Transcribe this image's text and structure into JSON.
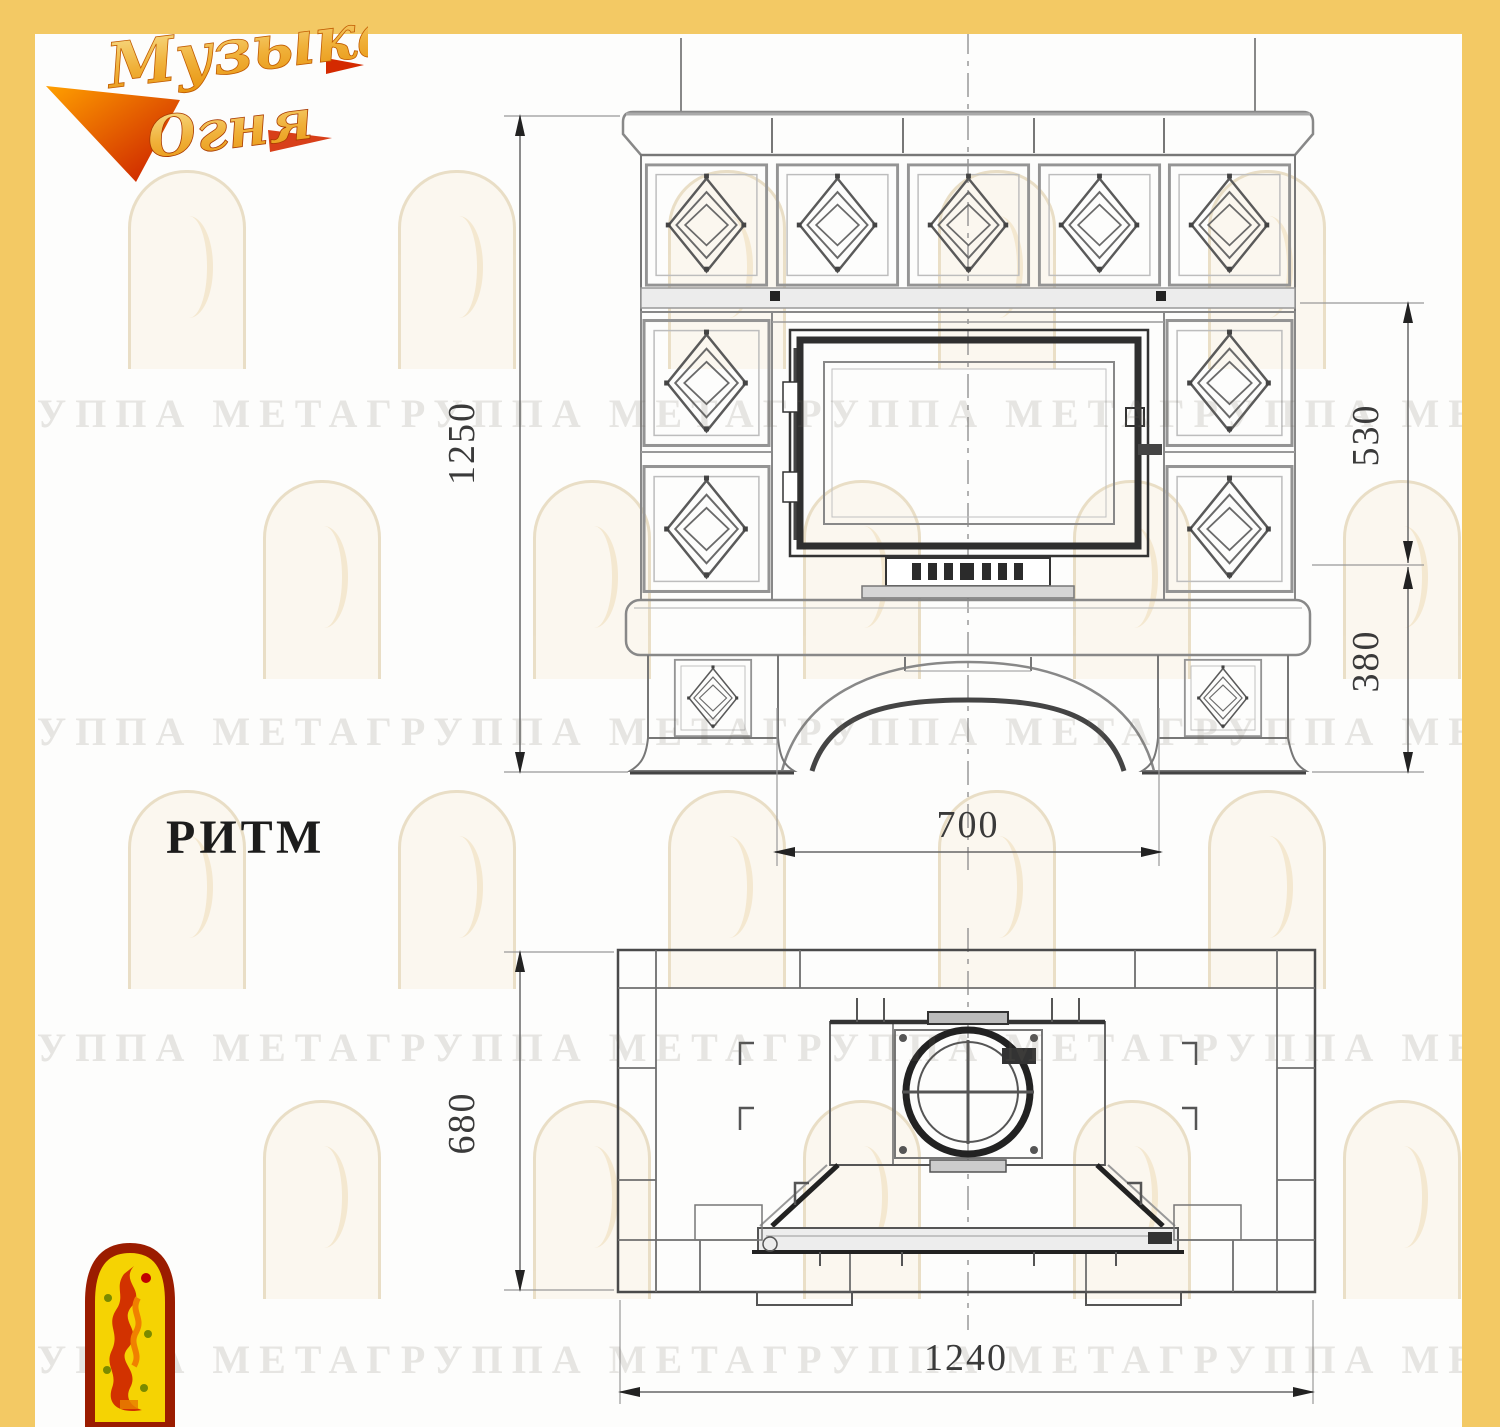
{
  "brand": {
    "name": "Музыка Огня",
    "line1": "Музыка",
    "line2": "Огня"
  },
  "model_label": "РИТМ",
  "watermark_text": "ГРУППА МЕТАГРУППА МЕТАГРУППА МЕТАГРУППА МЕТАГРУППА МЕТА",
  "dimensions": {
    "front": {
      "height": "1250",
      "upper": "530",
      "lower": "380",
      "opening": "700"
    },
    "plan": {
      "depth": "680",
      "width": "1240"
    }
  },
  "colors": {
    "frame_yellow": "#f3c964",
    "drawing_line": "#666666",
    "dark_line": "#2f2f2f",
    "logo_red": "#9b1c00",
    "logo_yellow": "#f5d303"
  }
}
